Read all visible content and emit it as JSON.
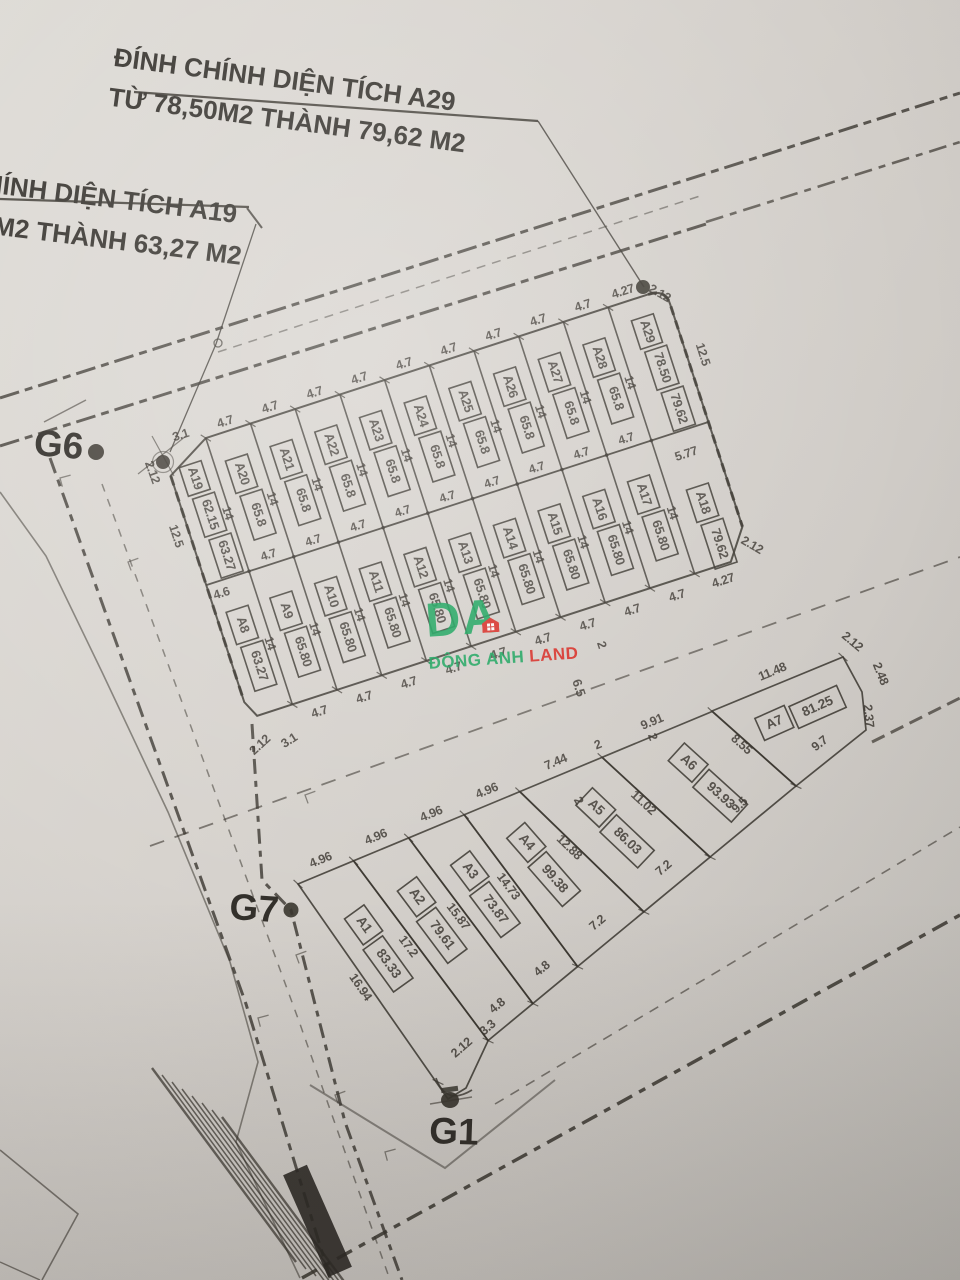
{
  "annotations": {
    "title_a29_line1": "ĐÍNH CHÍNH DIỆN TÍCH A29",
    "title_a29_line2": "TỪ 78,50M2 THÀNH 79,62 M2",
    "title_a19_line1": "HÍNH DIỆN TÍCH A19",
    "title_a19_line2": "5M2 THÀNH 63,27 M2"
  },
  "survey_points": {
    "g6": "G6",
    "g7": "G7",
    "g1": "G1"
  },
  "watermark": {
    "logo": "DA",
    "brand_green": "ĐÔNG ANH",
    "brand_red": "LAND",
    "green": "#18a35b",
    "red": "#d8241c"
  },
  "upper_block": {
    "strip_width_dim": "4.7",
    "strip_length_dim": "14",
    "top_row": [
      {
        "id": "A19",
        "areas": [
          "62.15",
          "63.27"
        ]
      },
      {
        "id": "A20",
        "areas": [
          "65.8"
        ]
      },
      {
        "id": "A21",
        "areas": [
          "65.8"
        ]
      },
      {
        "id": "A22",
        "areas": [
          "65.8"
        ]
      },
      {
        "id": "A23",
        "areas": [
          "65.8"
        ]
      },
      {
        "id": "A24",
        "areas": [
          "65.8"
        ]
      },
      {
        "id": "A25",
        "areas": [
          "65.8"
        ]
      },
      {
        "id": "A26",
        "areas": [
          "65.8"
        ]
      },
      {
        "id": "A27",
        "areas": [
          "65.8"
        ]
      },
      {
        "id": "A28",
        "areas": [
          "65.8"
        ]
      },
      {
        "id": "A29",
        "areas": [
          "78.50",
          "79.62"
        ]
      }
    ],
    "bottom_row": [
      {
        "id": "A8",
        "areas": [
          "63.27"
        ]
      },
      {
        "id": "A9",
        "areas": [
          "65.80"
        ]
      },
      {
        "id": "A10",
        "areas": [
          "65.80"
        ]
      },
      {
        "id": "A11",
        "areas": [
          "65.80"
        ]
      },
      {
        "id": "A12",
        "areas": [
          "65.80"
        ]
      },
      {
        "id": "A13",
        "areas": [
          "65.80"
        ]
      },
      {
        "id": "A14",
        "areas": [
          "65.80"
        ]
      },
      {
        "id": "A15",
        "areas": [
          "65.80"
        ]
      },
      {
        "id": "A16",
        "areas": [
          "65.80"
        ]
      },
      {
        "id": "A17",
        "areas": [
          "65.80"
        ]
      },
      {
        "id": "A18",
        "areas": [
          "79.62"
        ]
      }
    ],
    "dims": {
      "left_length": "12.5",
      "right_length": "12.5",
      "a29_bottom_width": "5.77",
      "a19_bottom_width": "4.6",
      "corner_top_left": [
        "2.12",
        "3.1"
      ],
      "corner_top_right": [
        "4.27",
        "2.12"
      ],
      "corner_bottom_left": [
        "2.12",
        "3.1"
      ],
      "corner_bottom_right": [
        "4.27",
        "2.12"
      ]
    }
  },
  "lower_block": {
    "plots": [
      {
        "id": "A1",
        "areas": [
          "83.33"
        ]
      },
      {
        "id": "A2",
        "areas": [
          "79.61"
        ]
      },
      {
        "id": "A3",
        "areas": [
          "73.87"
        ]
      },
      {
        "id": "A4",
        "areas": [
          "99.38"
        ]
      },
      {
        "id": "A5",
        "areas": [
          "86.03"
        ]
      },
      {
        "id": "A6",
        "areas": [
          "93.93"
        ]
      },
      {
        "id": "A7",
        "areas": [
          "81.25"
        ]
      }
    ],
    "top_dims": [
      "4.96",
      "4.96",
      "4.96",
      "4.96",
      "7.44",
      "2",
      "9.91",
      "11.48"
    ],
    "side_dims": [
      "16.94",
      "17.2",
      "15.87",
      "14.73",
      "12.88",
      "11.02",
      "8.55"
    ],
    "bottom_dims": [
      "2.12",
      "3.3",
      "4.8",
      "4.8",
      "7.2",
      "7.2",
      "9.5",
      "9.7"
    ],
    "corner_dims": [
      "2.12",
      "2.48",
      "2.37"
    ],
    "jog_dim": "2"
  },
  "road_dims": [
    "6.5",
    "2",
    "2"
  ]
}
